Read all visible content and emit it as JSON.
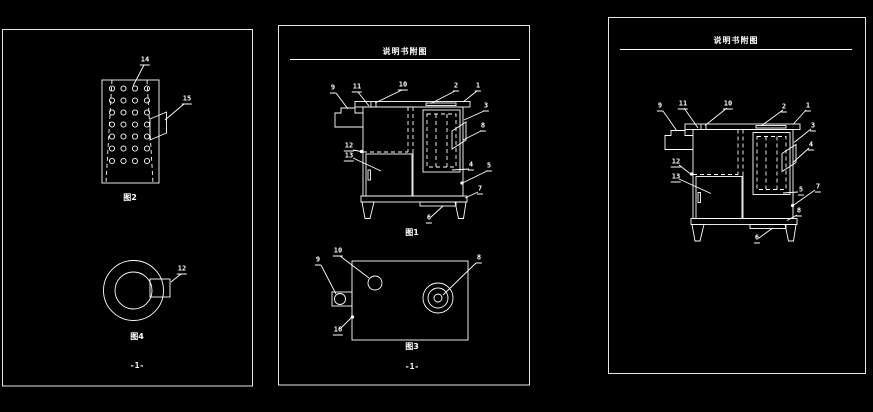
{
  "colors": {
    "background": "#000000",
    "line": "#ffffff"
  },
  "left_panel": {
    "figure_plate": {
      "label_14": "14",
      "label_15": "15",
      "caption": "图2"
    },
    "figure_ring": {
      "label_12": "12",
      "caption": "图4"
    },
    "page_marker": "-1-"
  },
  "middle_panel": {
    "title": "说明书附图",
    "figure_boiler": {
      "caption": "图1",
      "labels": {
        "n9": "9",
        "n11": "11",
        "n10": "10",
        "n2": "2",
        "n1": "1",
        "n3": "3",
        "n8": "8",
        "n12": "12",
        "n13": "13",
        "n4": "4",
        "n5": "5",
        "n7": "7",
        "n6": "6"
      }
    },
    "figure_base": {
      "caption": "图3",
      "labels": {
        "n10": "10",
        "n9": "9",
        "n16": "16",
        "n8": "8"
      }
    },
    "page_marker": "-1-"
  },
  "right_panel": {
    "title": "说明书附图",
    "figure_boiler": {
      "labels": {
        "n9": "9",
        "n11": "11",
        "n10": "10",
        "n2": "2",
        "n1": "1",
        "n3": "3",
        "n4": "4",
        "n12": "12",
        "n13": "13",
        "n5": "5",
        "n7": "7",
        "n8": "8",
        "n6": "6"
      }
    }
  }
}
